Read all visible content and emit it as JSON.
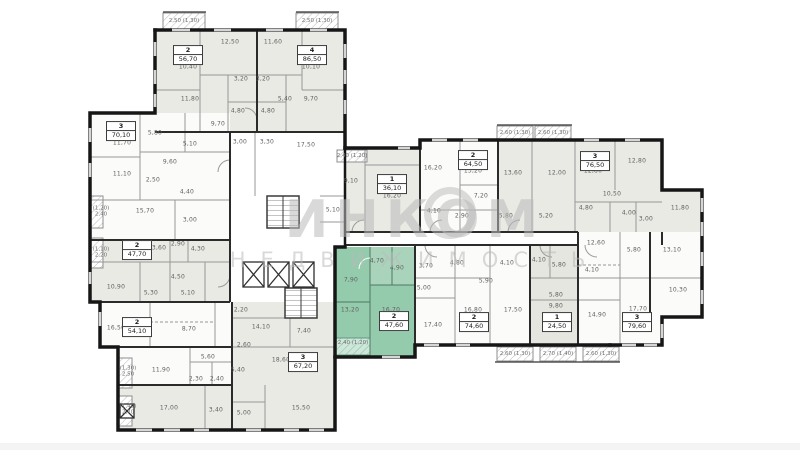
{
  "watermark": {
    "line1": "ИНКОМ",
    "line2": "НЕДВИЖИМОСТЬ"
  },
  "colors": {
    "highlight": "#94cbad",
    "highlight_light": "#b9dcc8",
    "room_gray": "#e9eae4",
    "room_white": "#fbfbf9",
    "wall": "#1a1a1a",
    "watermark": "#bababa"
  },
  "apartments": [
    {
      "type": "2",
      "area": "56,70",
      "x": 188,
      "y": 55,
      "highlighted": false
    },
    {
      "type": "4",
      "area": "86,50",
      "x": 312,
      "y": 55,
      "highlighted": false
    },
    {
      "type": "3",
      "area": "70,10",
      "x": 121,
      "y": 131,
      "highlighted": false
    },
    {
      "type": "2",
      "area": "47,70",
      "x": 137,
      "y": 250,
      "highlighted": false
    },
    {
      "type": "2",
      "area": "54,10",
      "x": 137,
      "y": 327,
      "highlighted": false
    },
    {
      "type": "3",
      "area": "67,20",
      "x": 303,
      "y": 362,
      "highlighted": false
    },
    {
      "type": "1",
      "area": "36,10",
      "x": 392,
      "y": 184,
      "highlighted": false
    },
    {
      "type": "2",
      "area": "47,60",
      "x": 394,
      "y": 321,
      "highlighted": true
    },
    {
      "type": "2",
      "area": "64,50",
      "x": 473,
      "y": 160,
      "highlighted": false
    },
    {
      "type": "3",
      "area": "76,50",
      "x": 595,
      "y": 161,
      "highlighted": false
    },
    {
      "type": "2",
      "area": "74,60",
      "x": 474,
      "y": 322,
      "highlighted": false
    },
    {
      "type": "1",
      "area": "24,50",
      "x": 557,
      "y": 322,
      "highlighted": false
    },
    {
      "type": "3",
      "area": "79,60",
      "x": 637,
      "y": 322,
      "highlighted": false
    }
  ],
  "room_labels": [
    {
      "t": "10,40",
      "x": 188,
      "y": 67
    },
    {
      "t": "12,50",
      "x": 230,
      "y": 42
    },
    {
      "t": "11,60",
      "x": 273,
      "y": 42
    },
    {
      "t": "10,10",
      "x": 311,
      "y": 67
    },
    {
      "t": "11,80",
      "x": 190,
      "y": 99
    },
    {
      "t": "3,20",
      "x": 241,
      "y": 79
    },
    {
      "t": "3,20",
      "x": 263,
      "y": 79
    },
    {
      "t": "5,40",
      "x": 285,
      "y": 99
    },
    {
      "t": "9,70",
      "x": 311,
      "y": 99
    },
    {
      "t": "4,80",
      "x": 238,
      "y": 111
    },
    {
      "t": "4,80",
      "x": 268,
      "y": 111
    },
    {
      "t": "9,70",
      "x": 218,
      "y": 124
    },
    {
      "t": "3,00",
      "x": 240,
      "y": 142
    },
    {
      "t": "3,30",
      "x": 267,
      "y": 142
    },
    {
      "t": "17,50",
      "x": 306,
      "y": 145
    },
    {
      "t": "5,10",
      "x": 190,
      "y": 144
    },
    {
      "t": "11,70",
      "x": 122,
      "y": 143
    },
    {
      "t": "5,80",
      "x": 155,
      "y": 133
    },
    {
      "t": "9,60",
      "x": 170,
      "y": 162
    },
    {
      "t": "11,10",
      "x": 122,
      "y": 174
    },
    {
      "t": "2,50",
      "x": 153,
      "y": 180
    },
    {
      "t": "4,40",
      "x": 187,
      "y": 192
    },
    {
      "t": "15,70",
      "x": 145,
      "y": 211
    },
    {
      "t": "3,00",
      "x": 190,
      "y": 220
    },
    {
      "t": "13,60",
      "x": 157,
      "y": 248
    },
    {
      "t": "2,90",
      "x": 178,
      "y": 244
    },
    {
      "t": "4,30",
      "x": 198,
      "y": 249
    },
    {
      "t": "4,50",
      "x": 178,
      "y": 277
    },
    {
      "t": "10,90",
      "x": 116,
      "y": 287
    },
    {
      "t": "5,30",
      "x": 151,
      "y": 293
    },
    {
      "t": "5,10",
      "x": 188,
      "y": 293
    },
    {
      "t": "16,50",
      "x": 116,
      "y": 328
    },
    {
      "t": "8,70",
      "x": 189,
      "y": 329
    },
    {
      "t": "5,60",
      "x": 208,
      "y": 357
    },
    {
      "t": "11,90",
      "x": 161,
      "y": 370
    },
    {
      "t": "2,30",
      "x": 196,
      "y": 379
    },
    {
      "t": "2,40",
      "x": 217,
      "y": 379
    },
    {
      "t": "5,40",
      "x": 238,
      "y": 370
    },
    {
      "t": "2,60",
      "x": 244,
      "y": 345
    },
    {
      "t": "2,20",
      "x": 241,
      "y": 310
    },
    {
      "t": "14,10",
      "x": 261,
      "y": 327
    },
    {
      "t": "7,40",
      "x": 304,
      "y": 331
    },
    {
      "t": "18,60",
      "x": 281,
      "y": 360
    },
    {
      "t": "17,00",
      "x": 169,
      "y": 408
    },
    {
      "t": "3,40",
      "x": 216,
      "y": 410
    },
    {
      "t": "5,00",
      "x": 244,
      "y": 413
    },
    {
      "t": "15,50",
      "x": 301,
      "y": 408
    },
    {
      "t": "9,10",
      "x": 351,
      "y": 181
    },
    {
      "t": "16,20",
      "x": 392,
      "y": 196
    },
    {
      "t": "5,10",
      "x": 333,
      "y": 210
    },
    {
      "t": "16,20",
      "x": 433,
      "y": 168
    },
    {
      "t": "7,20",
      "x": 481,
      "y": 196
    },
    {
      "t": "4,10",
      "x": 434,
      "y": 211
    },
    {
      "t": "2,90",
      "x": 462,
      "y": 216
    },
    {
      "t": "13,20",
      "x": 473,
      "y": 171
    },
    {
      "t": "13,60",
      "x": 513,
      "y": 173
    },
    {
      "t": "12,00",
      "x": 557,
      "y": 173
    },
    {
      "t": "12,80",
      "x": 593,
      "y": 171
    },
    {
      "t": "12,80",
      "x": 637,
      "y": 161
    },
    {
      "t": "10,50",
      "x": 612,
      "y": 194
    },
    {
      "t": "4,80",
      "x": 586,
      "y": 208
    },
    {
      "t": "4,00",
      "x": 629,
      "y": 213
    },
    {
      "t": "3,00",
      "x": 646,
      "y": 219
    },
    {
      "t": "11,80",
      "x": 680,
      "y": 208
    },
    {
      "t": "5,80",
      "x": 506,
      "y": 216
    },
    {
      "t": "5,20",
      "x": 546,
      "y": 216
    },
    {
      "t": "4,70",
      "x": 377,
      "y": 261
    },
    {
      "t": "4,90",
      "x": 397,
      "y": 268
    },
    {
      "t": "7,90",
      "x": 351,
      "y": 280
    },
    {
      "t": "13,20",
      "x": 350,
      "y": 310
    },
    {
      "t": "16,70",
      "x": 391,
      "y": 310
    },
    {
      "t": "3,70",
      "x": 426,
      "y": 266
    },
    {
      "t": "4,80",
      "x": 457,
      "y": 263
    },
    {
      "t": "5,90",
      "x": 486,
      "y": 281
    },
    {
      "t": "5,00",
      "x": 424,
      "y": 288
    },
    {
      "t": "17,40",
      "x": 433,
      "y": 325
    },
    {
      "t": "16,80",
      "x": 473,
      "y": 310
    },
    {
      "t": "17,50",
      "x": 513,
      "y": 310
    },
    {
      "t": "4,10",
      "x": 507,
      "y": 263
    },
    {
      "t": "4,10",
      "x": 539,
      "y": 260
    },
    {
      "t": "5,80",
      "x": 559,
      "y": 265
    },
    {
      "t": "5,80",
      "x": 556,
      "y": 295
    },
    {
      "t": "9,80",
      "x": 556,
      "y": 306
    },
    {
      "t": "12,60",
      "x": 596,
      "y": 243
    },
    {
      "t": "5,80",
      "x": 634,
      "y": 250
    },
    {
      "t": "13,10",
      "x": 672,
      "y": 250
    },
    {
      "t": "4,10",
      "x": 592,
      "y": 270
    },
    {
      "t": "10,30",
      "x": 678,
      "y": 290
    },
    {
      "t": "14,90",
      "x": 597,
      "y": 315
    },
    {
      "t": "17,70",
      "x": 638,
      "y": 309
    }
  ],
  "balcony_labels": [
    {
      "t": "2,50 (1,30)",
      "x": 184,
      "y": 21
    },
    {
      "t": "2,50 (1,30)",
      "x": 317,
      "y": 21
    },
    {
      "t": "2,40 (1,20)",
      "x": 352,
      "y": 156
    },
    {
      "t": "2,60 (1,30)",
      "x": 515,
      "y": 133
    },
    {
      "t": "2,60 (1,30)",
      "x": 553,
      "y": 133
    },
    {
      "t": "2,40 (1,20)",
      "x": 353,
      "y": 343
    },
    {
      "t": "2,60 (1,30)",
      "x": 515,
      "y": 354
    },
    {
      "t": "2,70 (1,40)",
      "x": 558,
      "y": 354
    },
    {
      "t": "2,60 (1,30)",
      "x": 601,
      "y": 354
    },
    {
      "t": "(1,20)\n2,40",
      "x": 101,
      "y": 212
    },
    {
      "t": "(1,10)\n2,20",
      "x": 101,
      "y": 253
    },
    {
      "t": "(1,30)\n2,50",
      "x": 128,
      "y": 372
    },
    {
      "t": "(1,40)\n2,70",
      "x": 128,
      "y": 410
    }
  ]
}
